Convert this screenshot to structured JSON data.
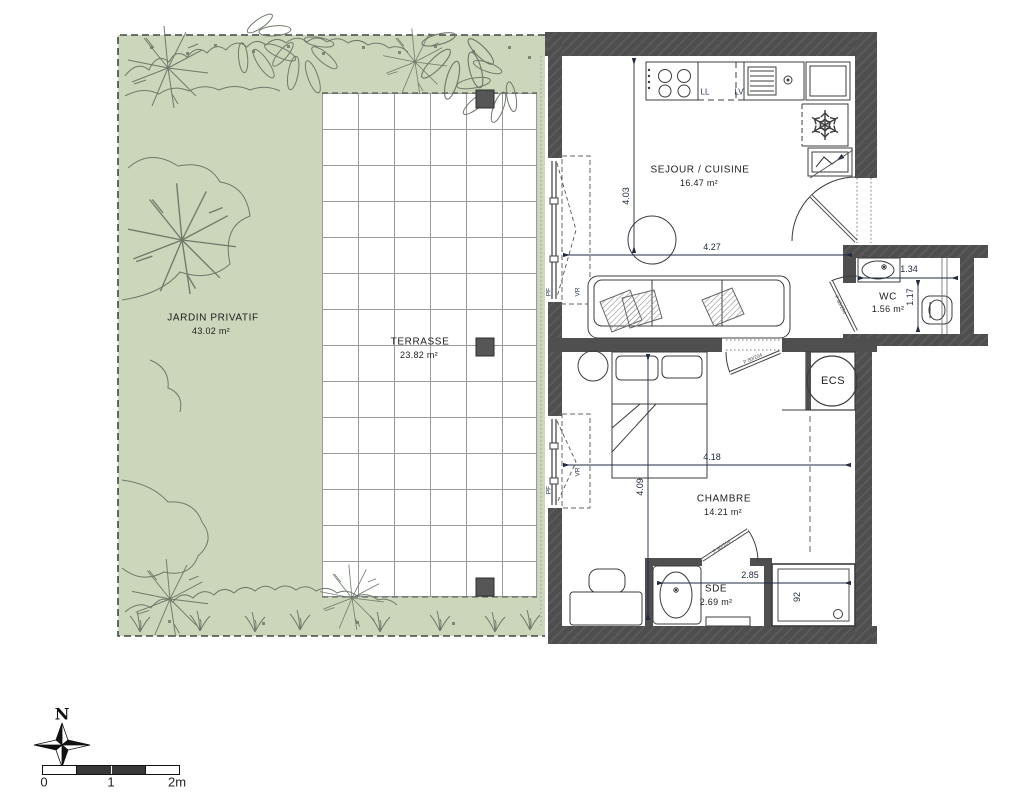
{
  "rooms": {
    "jardin": {
      "name": "JARDIN PRIVATIF",
      "area": "43.02 m²"
    },
    "terrasse": {
      "name": "TERRASSE",
      "area": "23.82 m²"
    },
    "sejour": {
      "name": "SEJOUR / CUISINE",
      "area": "16.47 m²"
    },
    "wc": {
      "name": "WC",
      "area": "1.56 m²"
    },
    "chambre": {
      "name": "CHAMBRE",
      "area": "14.21 m²"
    },
    "sde": {
      "name": "SDE",
      "area": "2.69 m²"
    },
    "ecs": {
      "name": "ECS"
    }
  },
  "dims": {
    "sejour_h": "4.03",
    "sejour_w": "4.27",
    "chambre_w": "4.18",
    "chambre_h": "4.09",
    "wc_w": "1.34",
    "wc_h": "1.17",
    "sde_w": "2.85",
    "shower_w": "92"
  },
  "ann": {
    "ll": "LL",
    "lv": "LV",
    "pf": "PF",
    "vr": "VR",
    "door": "P 80/204"
  },
  "compass": {
    "label": "N"
  },
  "scale": {
    "t": [
      "0",
      "1",
      "2m"
    ]
  },
  "colors": {
    "garden": "#ccd6ba",
    "wall": "#4e4e4e",
    "plant_line": "#6f7a6b",
    "dim_text": "#222a40",
    "line": "#3c3c3c"
  }
}
